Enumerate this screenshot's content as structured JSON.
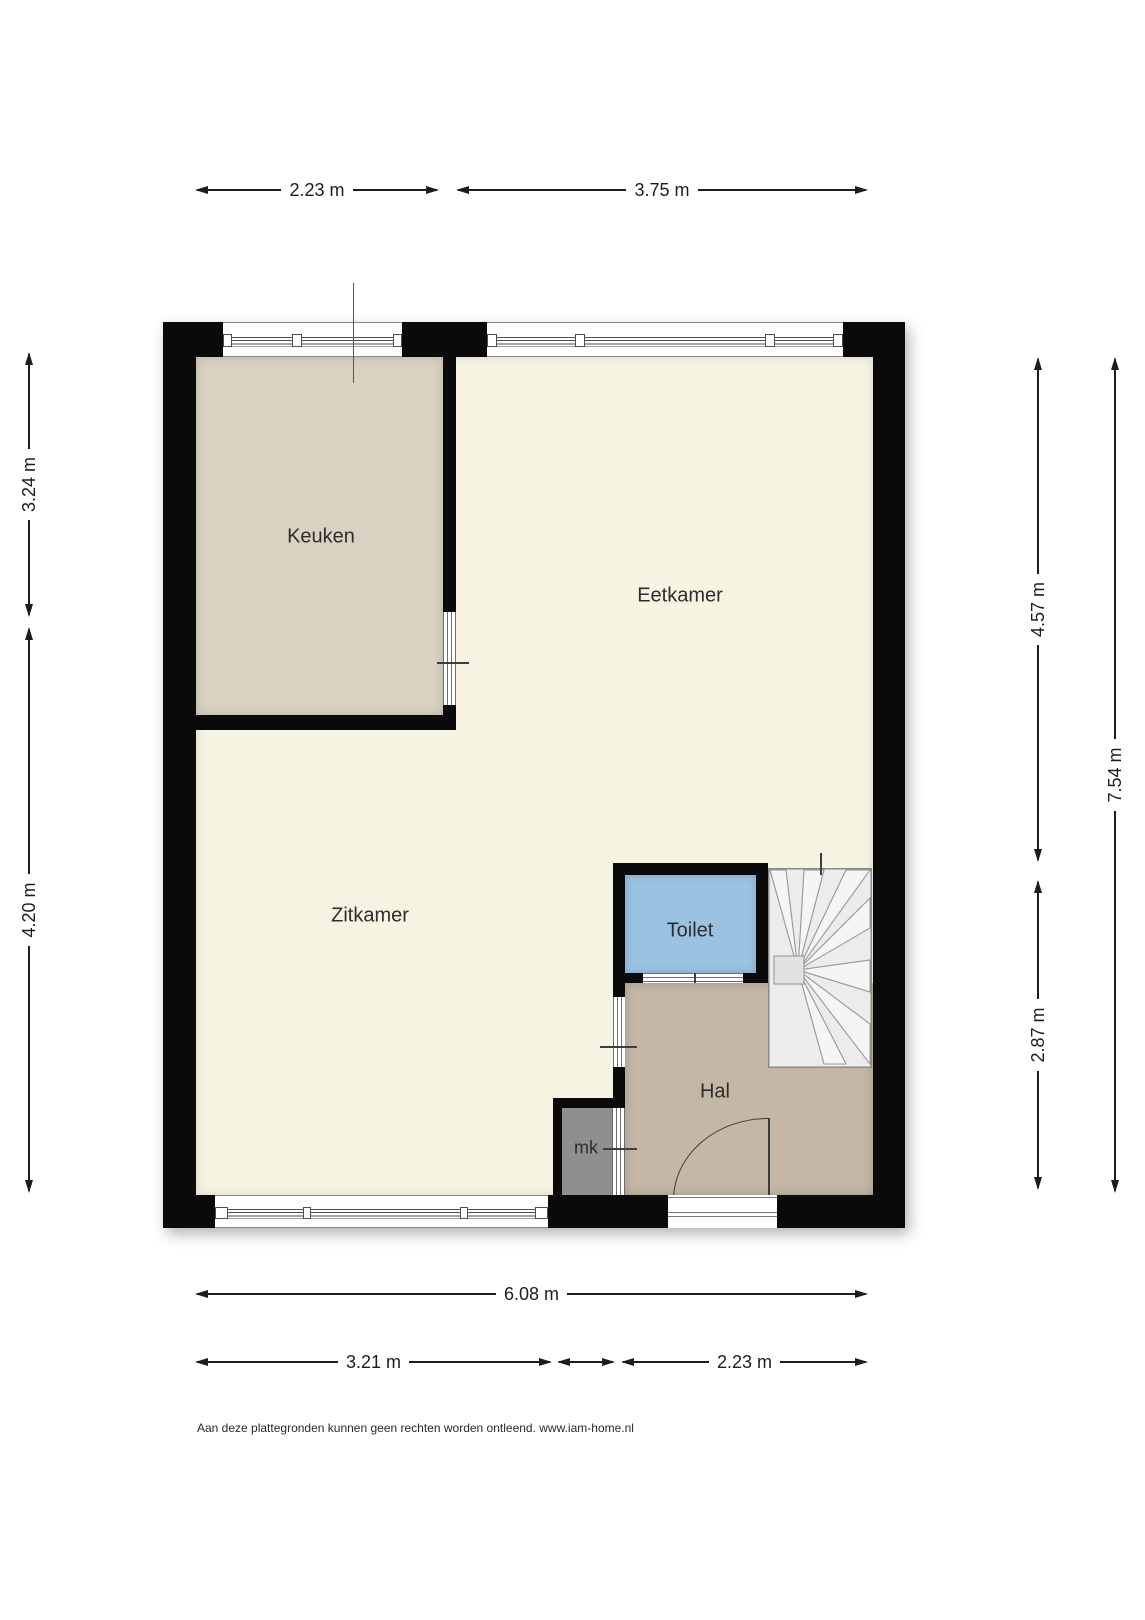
{
  "rooms": {
    "keuken": "Keuken",
    "eetkamer": "Eetkamer",
    "zitkamer": "Zitkamer",
    "toilet": "Toilet",
    "hal": "Hal",
    "mk": "mk"
  },
  "dimensions": {
    "top_left": "2.23 m",
    "top_right": "3.75 m",
    "left_upper": "3.24 m",
    "left_lower": "4.20 m",
    "right_inner_upper": "4.57 m",
    "right_inner_lower": "2.87 m",
    "right_outer": "7.54 m",
    "bottom_total": "6.08 m",
    "bottom_left": "3.21 m",
    "bottom_middle": "",
    "bottom_right": "2.23 m"
  },
  "footer": "Aan deze plattegronden kunnen geen rechten worden ontleend. www.iam-home.nl",
  "colors": {
    "wall": "#0a0a0a",
    "floor_main": "#f6f3e2",
    "floor_keuken": "#d9d2c3",
    "floor_toilet": "#9cc2e2",
    "floor_hal": "#c4b7a6",
    "floor_mk": "#8f8f8f",
    "stairs": "#ececec",
    "dim": "#1d1d1d"
  }
}
